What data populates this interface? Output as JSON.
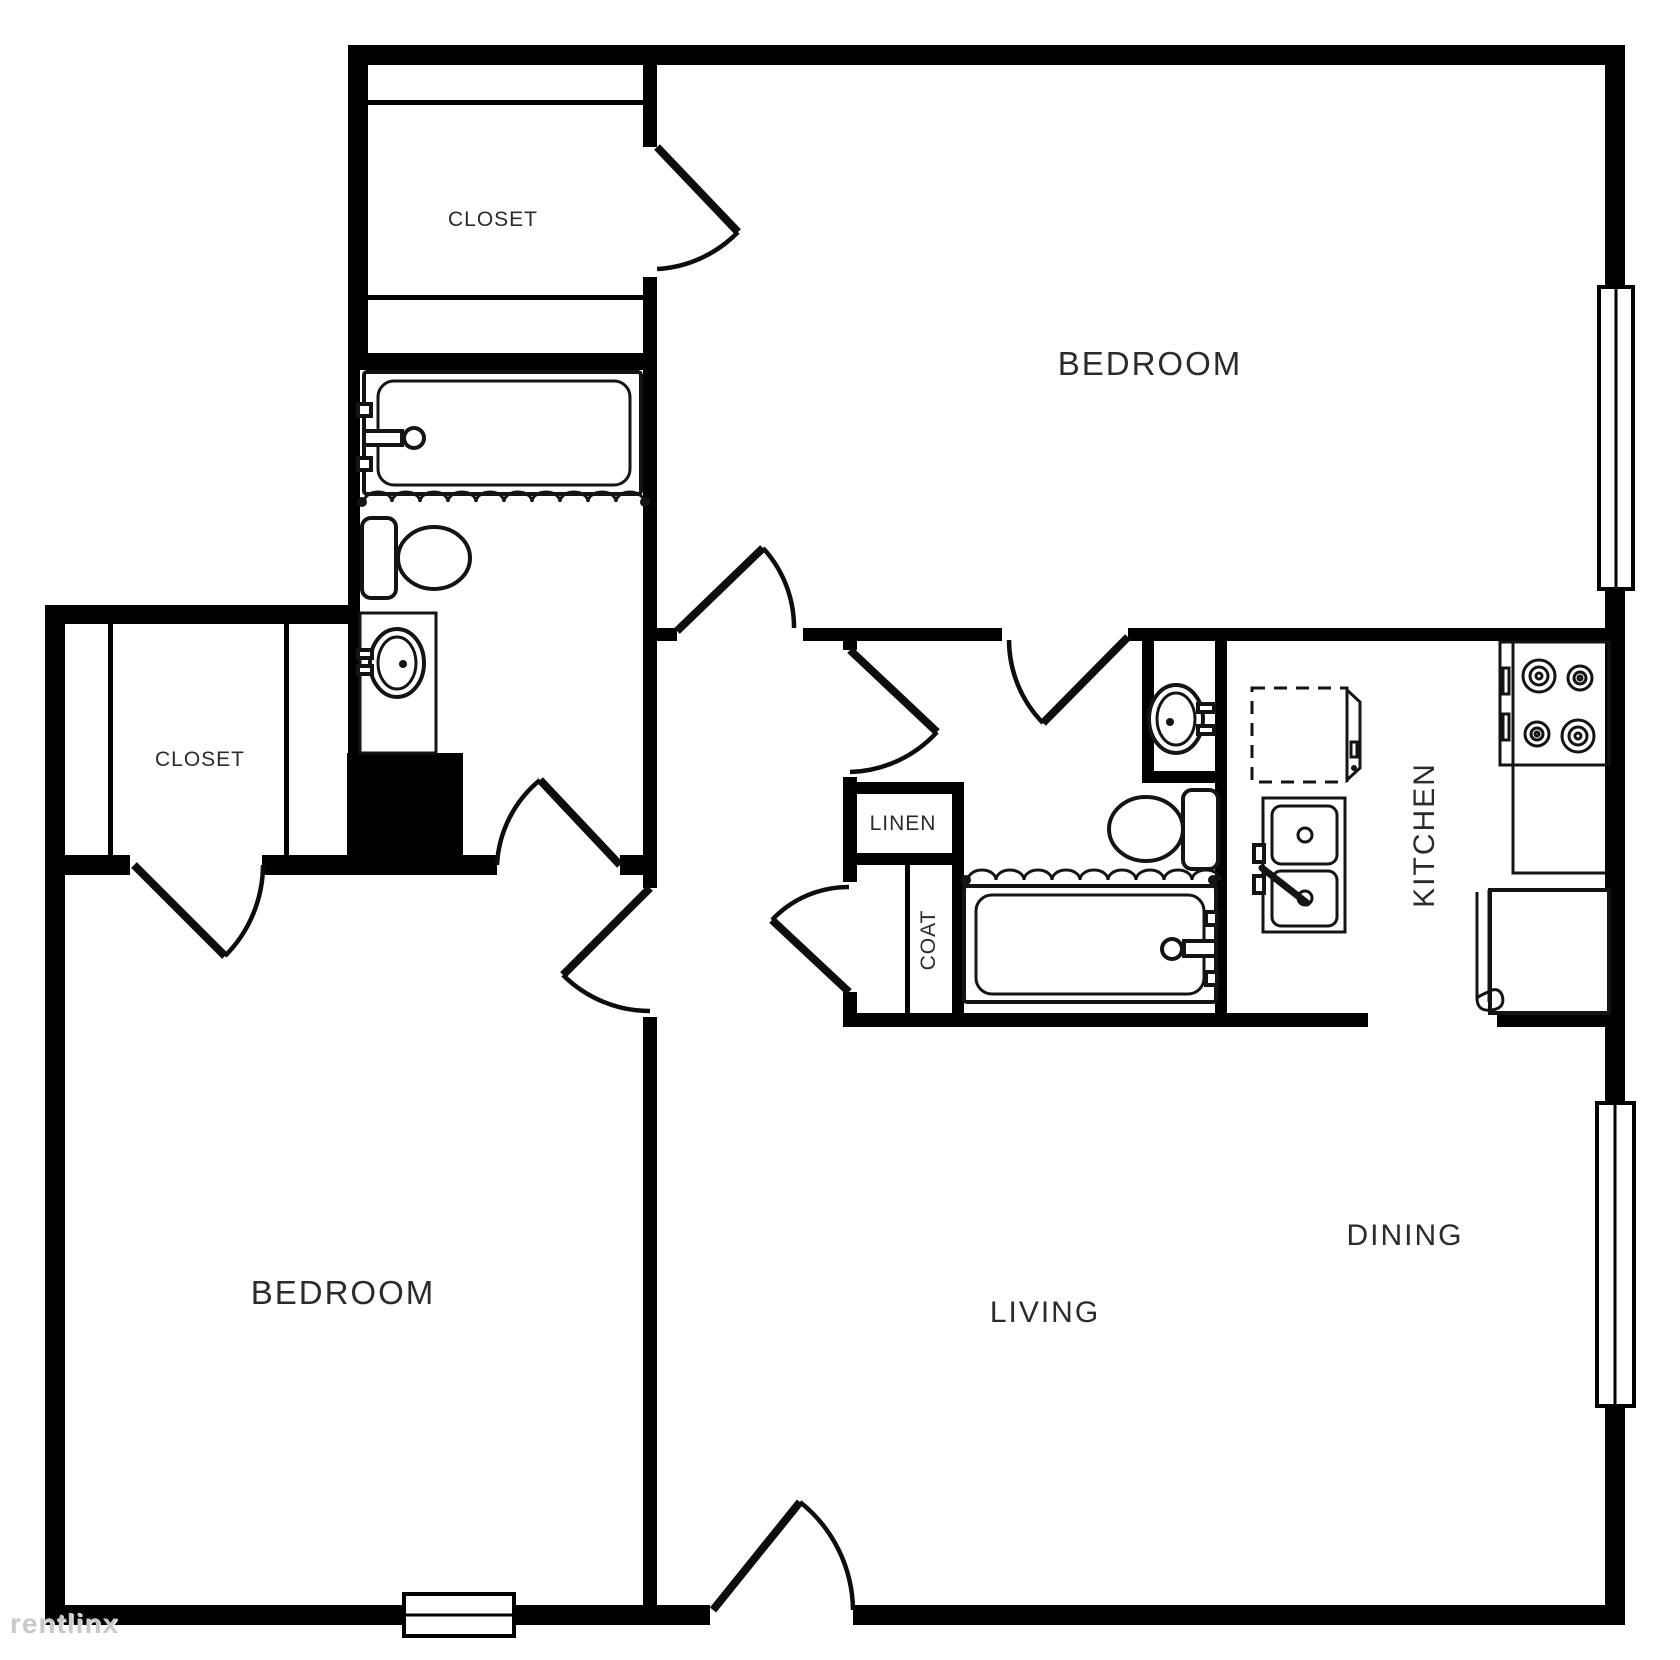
{
  "labels": {
    "bedroom_top_right": "BEDROOM",
    "bedroom_bottom_left": "BEDROOM",
    "living": "LIVING",
    "dining": "DINING",
    "kitchen": "KITCHEN",
    "closet_top": "CLOSET",
    "closet_bedroom": "CLOSET",
    "linen": "LINEN",
    "coat": "COAT"
  },
  "watermark": "rentlinx",
  "colors": {
    "walls": "#000000",
    "background": "#ffffff",
    "fixture_stroke": "#141414",
    "label_text": "#2b2b2b",
    "watermark": "#c9c9c9"
  },
  "fixtures": [
    "bathtub",
    "shower-curtain",
    "toilet",
    "vanity-sink",
    "kitchen-sink",
    "dishwasher",
    "stove",
    "counter",
    "refrigerator",
    "window",
    "door-swing"
  ]
}
